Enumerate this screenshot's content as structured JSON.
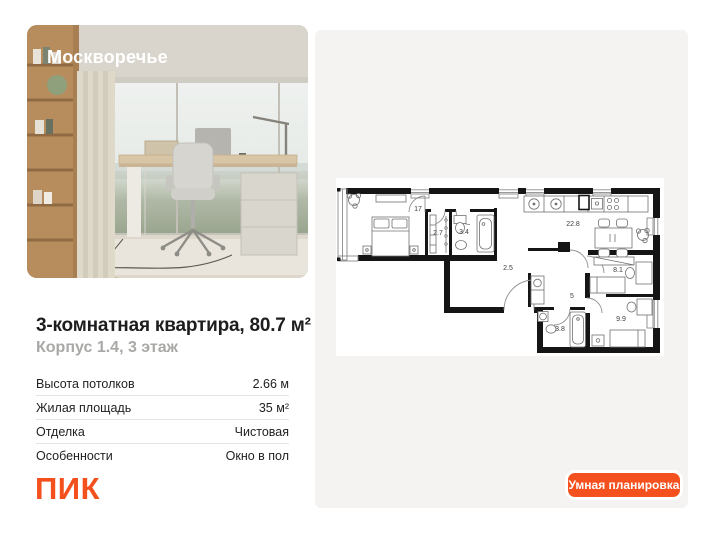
{
  "listing": {
    "project": "Москворечье",
    "title": "3-комнатная квартира, 80.7 м²",
    "subtitle": "Корпус 1.4, 3 этаж",
    "specs": [
      {
        "label": "Высота потолков",
        "value": "2.66 м"
      },
      {
        "label": "Жилая площадь",
        "value": "35 м²"
      },
      {
        "label": "Отделка",
        "value": "Чистовая"
      },
      {
        "label": "Особенности",
        "value": "Окно в пол"
      }
    ],
    "brand": "ПИК"
  },
  "floorplan": {
    "button_label": "Умная планировка",
    "rooms": [
      {
        "name": "bedroom",
        "area": "17"
      },
      {
        "name": "wardrobe",
        "area": "2.7"
      },
      {
        "name": "bathroom",
        "area": "3.4"
      },
      {
        "name": "kitchen-living",
        "area": "22.8"
      },
      {
        "name": "hallway",
        "area": "2.5"
      },
      {
        "name": "corridor",
        "area": "5"
      },
      {
        "name": "room",
        "area": "8.1"
      },
      {
        "name": "bedroom-2",
        "area": "9.9"
      },
      {
        "name": "bathroom-2",
        "area": "3.8"
      }
    ]
  },
  "colors": {
    "accent": "#f4511e",
    "panel": "#f4f3f1",
    "brand_orange": "#f4501e"
  }
}
